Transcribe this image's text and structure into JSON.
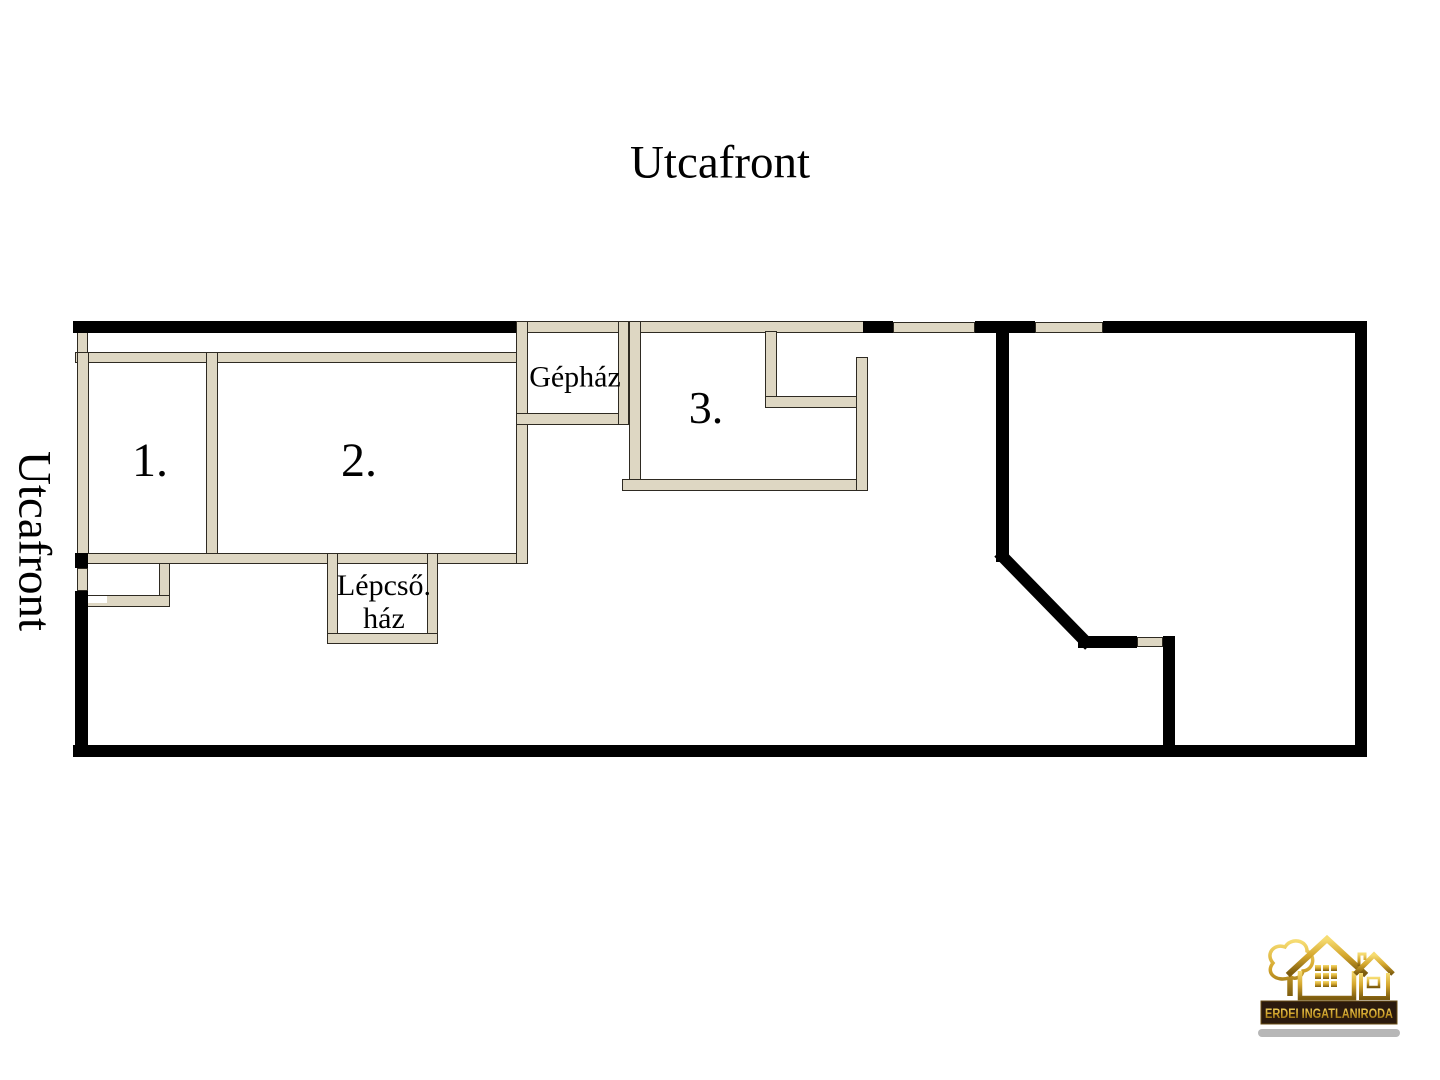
{
  "labels": {
    "street_front_top": "Utcafront",
    "street_front_left": "Utcafront"
  },
  "plan": {
    "rooms": [
      {
        "id": "room-1",
        "label": "1."
      },
      {
        "id": "room-2",
        "label": "2."
      },
      {
        "id": "room-3",
        "label": "3."
      },
      {
        "id": "machine-room",
        "label": "Gépház"
      },
      {
        "id": "stairwell",
        "label_line_1": "Lépcső.",
        "label_line_2": "ház"
      }
    ],
    "colors": {
      "outer_wall": "#000000",
      "inner_wall_fill": "#ded7c3",
      "inner_wall_outline": "#2e2a22",
      "background": "#ffffff"
    }
  },
  "logo": {
    "agency_name": "ERDEI INGATLANIRODA",
    "colors": {
      "gold": "#d4a62c",
      "banner": "#2b1a0d",
      "shadow_bar": "#b7b7b7"
    }
  }
}
